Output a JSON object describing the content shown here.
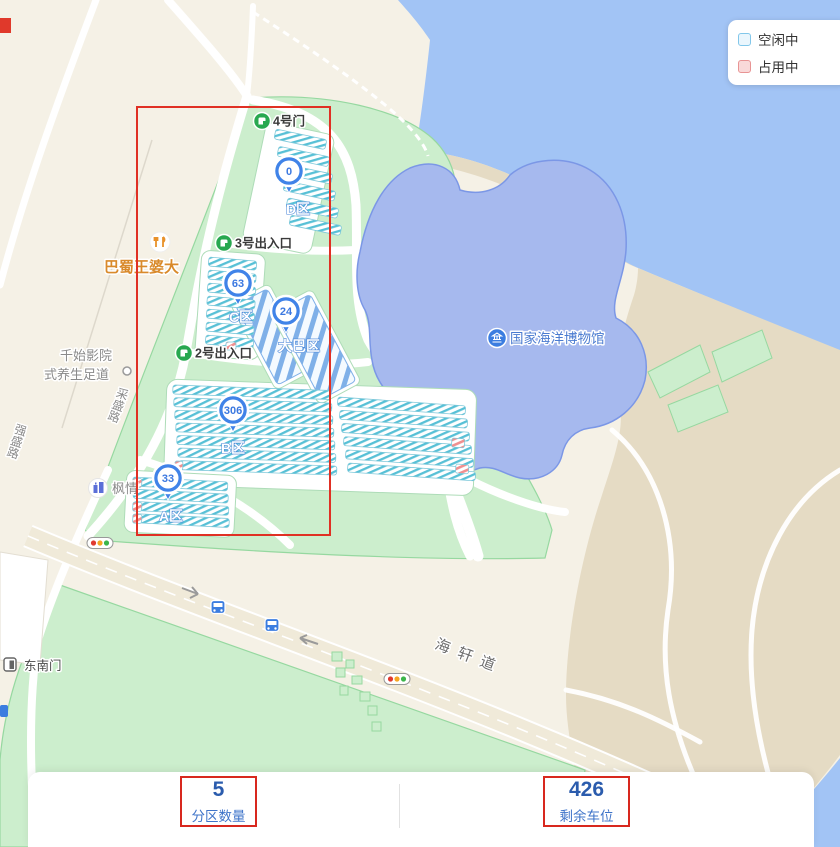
{
  "legend": {
    "free": {
      "label": "空闲中",
      "fill": "#eaf6fd",
      "border": "#82c7ea"
    },
    "occupied": {
      "label": "占用中",
      "fill": "#f9d9d9",
      "border": "#e89494"
    }
  },
  "map": {
    "museum": {
      "label": "国家海洋博物馆"
    },
    "gates": [
      {
        "label": "4号门"
      },
      {
        "label": "3号出入口"
      },
      {
        "label": "2号出入口"
      }
    ],
    "zones": [
      {
        "label": "D区",
        "available": "0"
      },
      {
        "label": "C区",
        "available": "63"
      },
      {
        "label": "大巴区",
        "available": "24"
      },
      {
        "label": "B区",
        "available": "306"
      },
      {
        "label": "A区",
        "available": "33"
      }
    ],
    "pois": [
      {
        "label": "巴蜀王婆大"
      },
      {
        "line1": "千始影院",
        "line2": "式养生足道"
      },
      {
        "label": "枫情"
      },
      {
        "label": "东南门"
      }
    ],
    "roads": [
      {
        "label": "海轩道"
      },
      {
        "label": "采盛路"
      },
      {
        "label": "强盛路"
      }
    ],
    "colors": {
      "water": "#a2c4f5",
      "pond": "#a6b9ee",
      "park": "#cceecd",
      "sand": "#e5dbc4",
      "free_stripe": "#57c0d6",
      "occupied_stripe": "#f09090",
      "bus_stripe": "#7fb0e8",
      "marker": "#4083e8",
      "gate": "#28a850",
      "annotation": "#e03024"
    }
  },
  "stats": {
    "partitions": {
      "value": "5",
      "label": "分区数量"
    },
    "remaining": {
      "value": "426",
      "label": "剩余车位"
    }
  }
}
